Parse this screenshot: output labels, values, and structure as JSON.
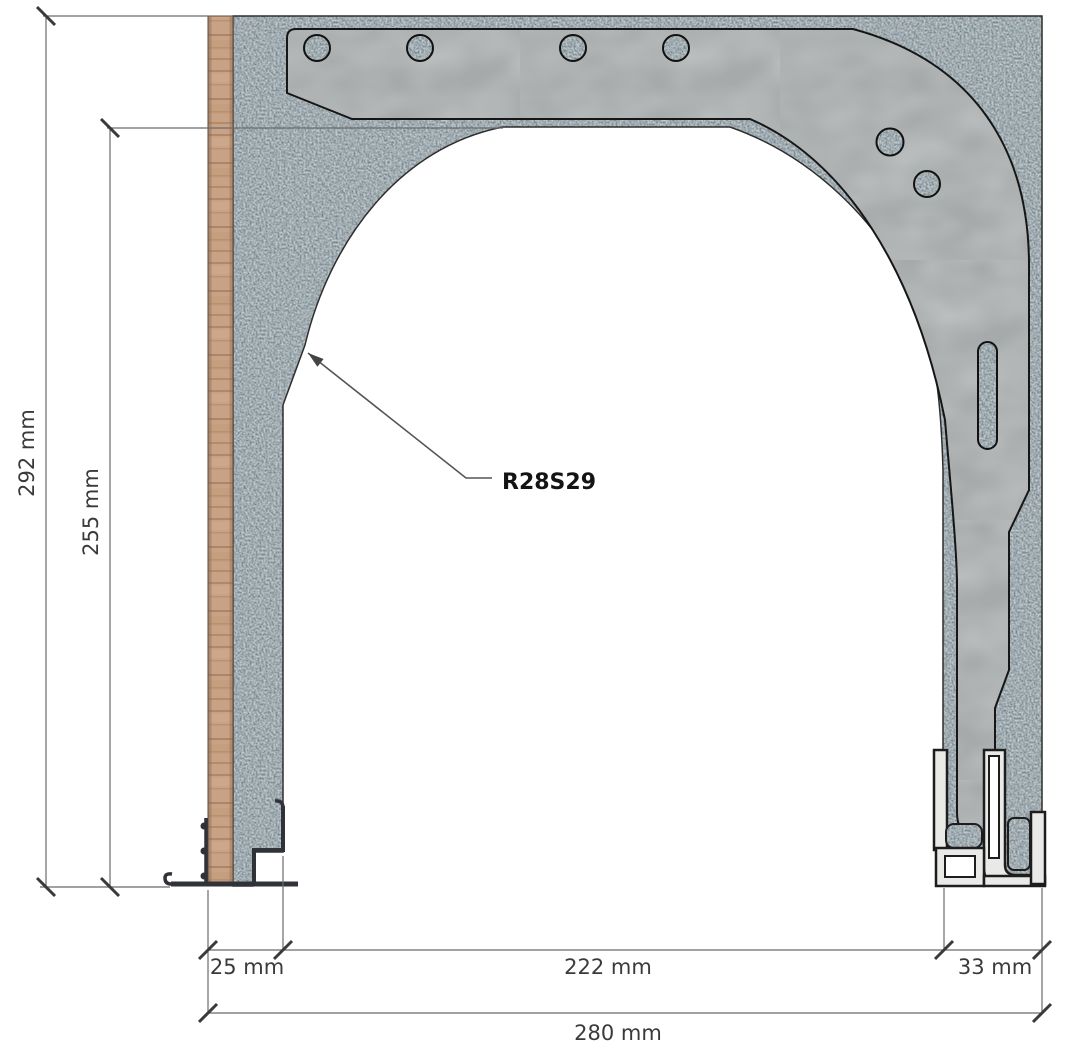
{
  "drawing": {
    "part_label": "R28S29",
    "dimensions": {
      "overall_height": "292 mm",
      "inner_height": "255 mm",
      "wall_thickness": "25 mm",
      "opening_width": "222 mm",
      "guide_rail_width": "33 mm",
      "overall_width": "280 mm"
    },
    "materials": {
      "insulation_base_color": "#6f7e85",
      "insulation_speckle_dark": "#42515a",
      "insulation_speckle_light": "#9ea9ad",
      "wood_color": "#c9a285",
      "wood_grain_color": "#a87d60",
      "steel_bracket_color": "#a6aaaa",
      "aluminum_profile_color": "#e9e9e7",
      "track_profile_color": "#2f3338",
      "outline_color": "#161616",
      "dimension_line_color": "#6b6b6b",
      "tick_color": "#3a3a3a",
      "text_color": "#3a3a3a"
    }
  }
}
